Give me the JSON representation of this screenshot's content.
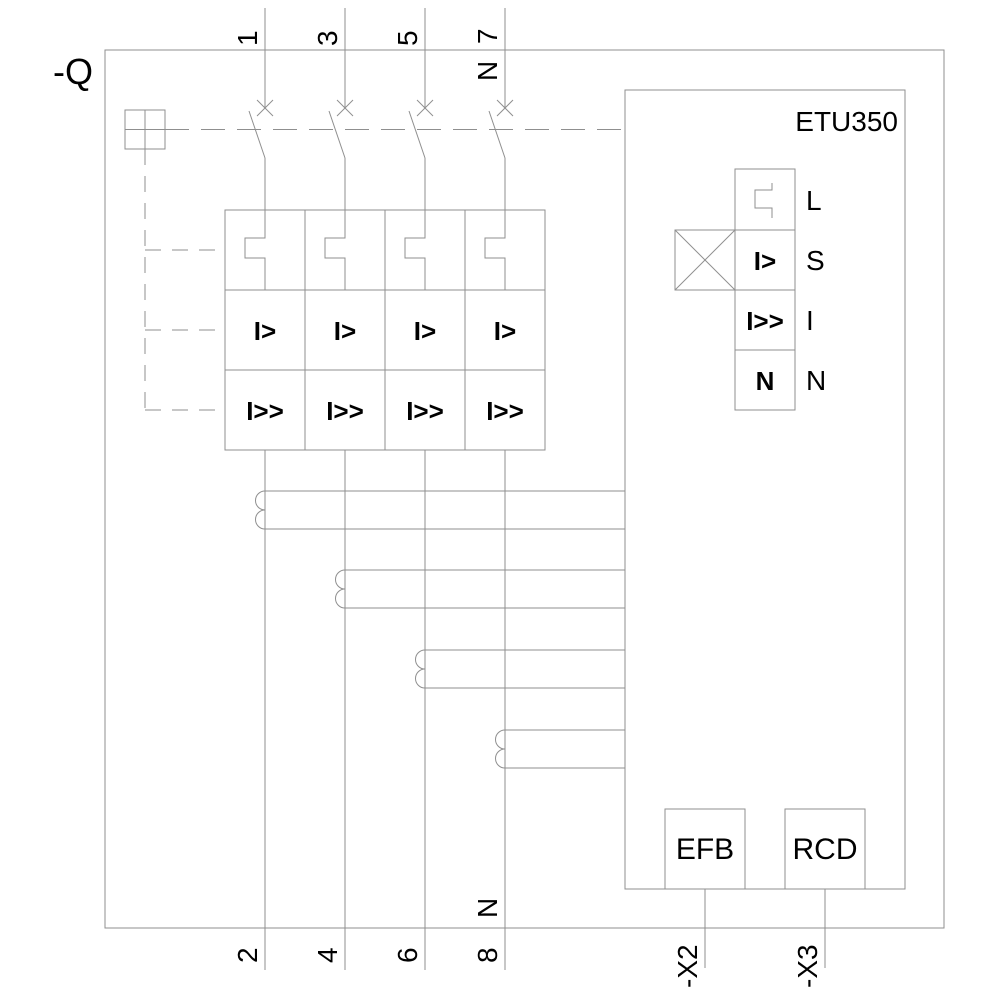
{
  "device": {
    "label": "-Q",
    "trip_unit_label": "ETU350"
  },
  "terminals": {
    "top": [
      "1",
      "3",
      "5",
      "7"
    ],
    "bottom": [
      "2",
      "4",
      "6",
      "8"
    ],
    "neutral_top": "N",
    "neutral_bottom": "N"
  },
  "releases": {
    "overload_label": "I>",
    "short_circuit_label": "I>>"
  },
  "etu_functions": [
    {
      "glyph": "inverse-time-latch",
      "symbol": "",
      "label": "L"
    },
    {
      "glyph": "text",
      "symbol": "I>",
      "label": "S"
    },
    {
      "glyph": "text",
      "symbol": "I>>",
      "label": "I"
    },
    {
      "glyph": "text",
      "symbol": "N",
      "label": "N"
    }
  ],
  "modules": {
    "efb_label": "EFB",
    "rcd_label": "RCD"
  },
  "connectors": {
    "x2_label": "-X2",
    "x3_label": "-X3"
  },
  "colors": {
    "line": "#8f8f8f",
    "text": "#000000",
    "background": "#ffffff"
  }
}
